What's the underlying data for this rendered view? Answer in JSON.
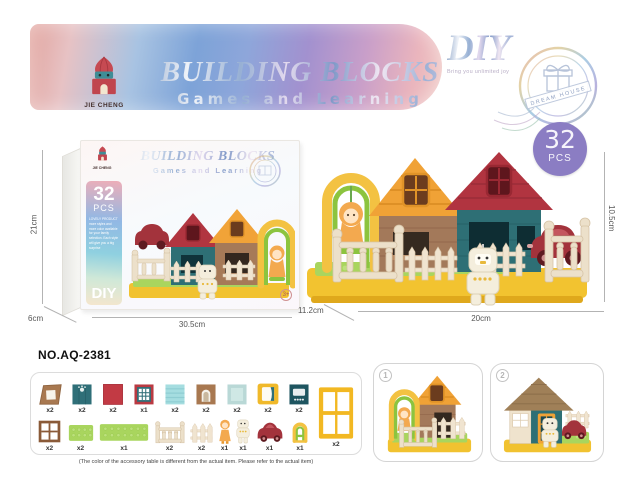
{
  "banner": {
    "title": "BUILDING BLOCKS",
    "subtitle": "Games and Learning",
    "logo_text": "JIE CHENG",
    "diy_label": "DIY",
    "diy_tagline": "Bring you unlimited joy",
    "stamp_text": "DREAM HOUSE"
  },
  "box": {
    "logo_text": "JIE CHENG",
    "title": "BUILDING BLOCKS",
    "subtitle": "Games and Learning",
    "pieces_count": "32",
    "pieces_unit": "PCS",
    "description": "LOVELY PRODUCT more styles and more color available for your family selection. Each style will give you a big surprise",
    "diy_label": "DIY",
    "age_badge": "3+",
    "height_label": "21cm",
    "depth_label": "6cm",
    "width_label": "30.5cm"
  },
  "product": {
    "badge_count": "32",
    "badge_unit": "PCS",
    "height_label": "10.5cm",
    "depth_label": "11.2cm",
    "width_label": "20cm"
  },
  "model_number": "NO.AQ-2381",
  "accessories": {
    "row1": [
      {
        "name": "roof-gable-panel",
        "qty": "x2"
      },
      {
        "name": "teal-plank-panel",
        "qty": "x2"
      },
      {
        "name": "red-panel",
        "qty": "x2"
      },
      {
        "name": "grid-window-panel",
        "qty": "x1"
      },
      {
        "name": "cyan-striped-panel",
        "qty": "x2"
      },
      {
        "name": "arch-window-panel",
        "qty": "x2"
      },
      {
        "name": "pale-teal-panel",
        "qty": "x2"
      },
      {
        "name": "yellow-frame-panel",
        "qty": "x2"
      },
      {
        "name": "teal-window-panel",
        "qty": "x2"
      }
    ],
    "row2": [
      {
        "name": "brown-window-frame",
        "qty": "x2"
      },
      {
        "name": "green-plate-small",
        "qty": "x2"
      },
      {
        "name": "green-plate-large",
        "qty": "x1"
      },
      {
        "name": "balustrade-fence",
        "qty": "x2"
      },
      {
        "name": "picket-fence",
        "qty": "x2"
      },
      {
        "name": "orange-figure",
        "qty": "x1"
      },
      {
        "name": "robot-figure",
        "qty": "x1"
      },
      {
        "name": "red-car",
        "qty": "x1"
      },
      {
        "name": "swing-frame",
        "qty": "x1"
      }
    ],
    "tall_item": {
      "name": "yellow-window",
      "qty": "x2"
    },
    "caption": "(The color of the accessory table is different from the actual item. Please refer to the actual item)"
  },
  "views": [
    {
      "num": "1"
    },
    {
      "num": "2"
    }
  ]
}
